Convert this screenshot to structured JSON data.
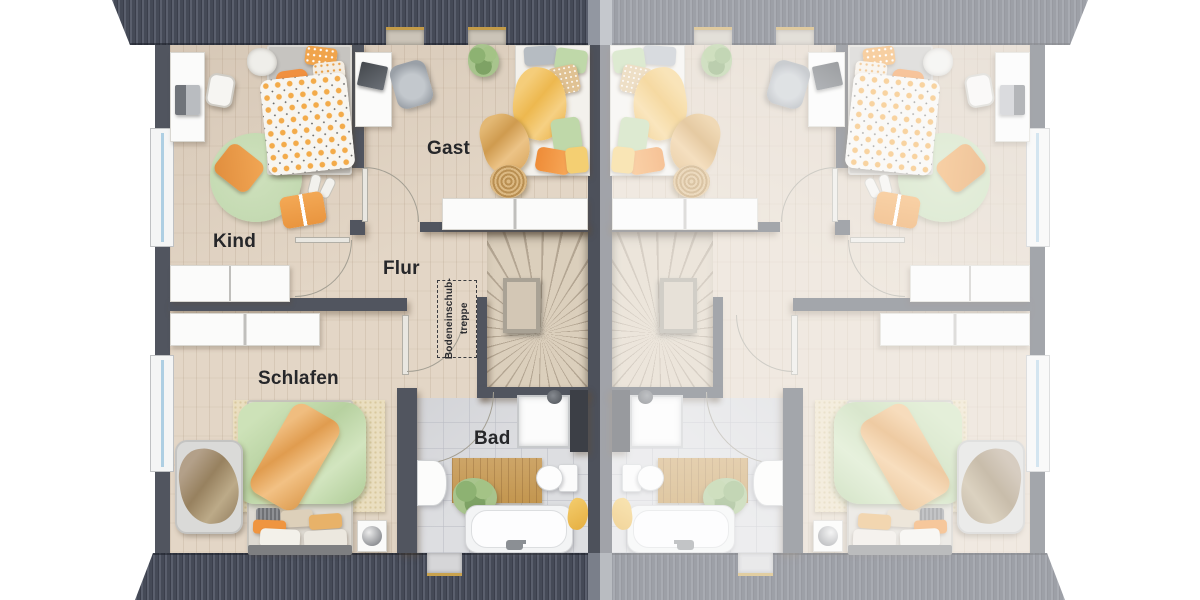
{
  "floorplan": {
    "labels": {
      "kind": "Kind",
      "gast": "Gast",
      "flur": "Flur",
      "schlafen": "Schlafen",
      "bad": "Bad"
    },
    "attic_note": {
      "line1": "Bodeneinschub-",
      "line2": "treppe"
    },
    "colors": {
      "roof": "#474b58",
      "wall": "#51555f",
      "wood_floor": "#e3d6c6",
      "tile_floor": "#dddee1",
      "accent_orange": "#ec9440",
      "accent_green": "#bfd8a9",
      "accent_yellow": "#f1c469",
      "rug_green": "#c4dab2",
      "label_text": "#26272a"
    }
  }
}
